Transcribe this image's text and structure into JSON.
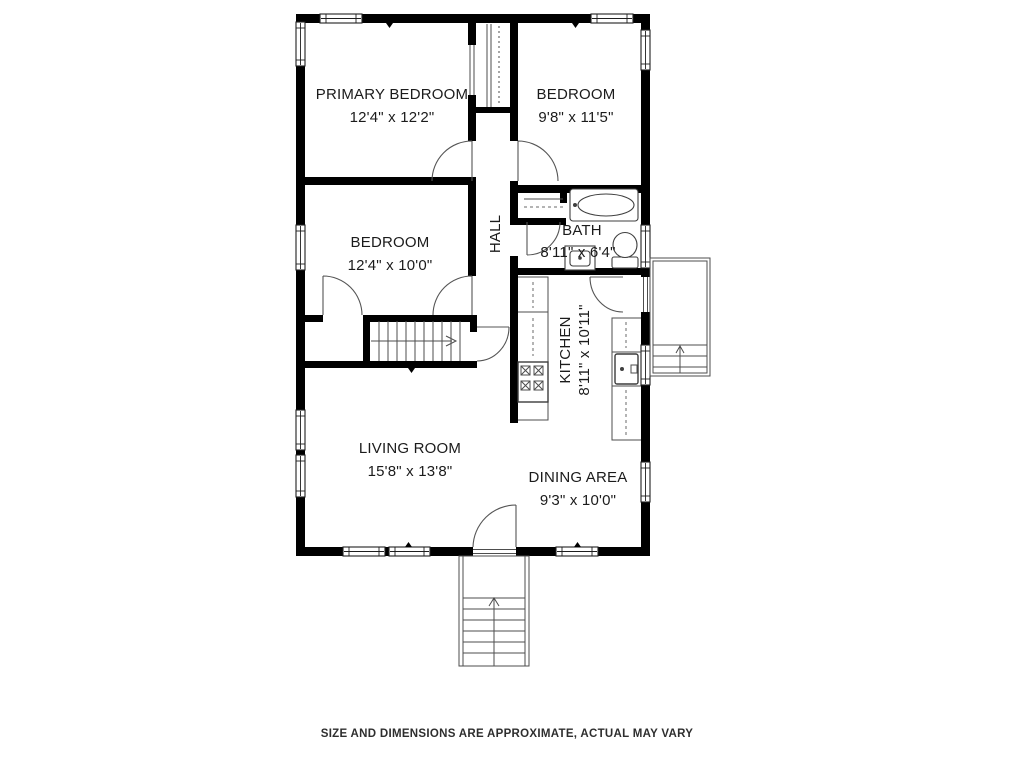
{
  "page": {
    "background_color": "#ffffff",
    "disclaimer": "SIZE AND DIMENSIONS ARE APPROXIMATE, ACTUAL MAY VARY"
  },
  "floorplan": {
    "wall_color": "#000000",
    "detail_line_color": "#4d4d4d",
    "text_color": "#1b1b1b",
    "rooms": [
      {
        "name": "PRIMARY BEDROOM",
        "dims": "12'4\" x 12'2\""
      },
      {
        "name": "BEDROOM",
        "dims": "9'8\" x 11'5\""
      },
      {
        "name": "BEDROOM",
        "dims": "12'4\" x 10'0\""
      },
      {
        "name": "HALL",
        "dims": ""
      },
      {
        "name": "BATH",
        "dims": "8'11\" x 6'4\""
      },
      {
        "name": "KITCHEN",
        "dims": "8'11\" x 10'11\""
      },
      {
        "name": "LIVING ROOM",
        "dims": "15'8\" x 13'8\""
      },
      {
        "name": "DINING AREA",
        "dims": "9'3\" x 10'0\""
      }
    ],
    "feature_icons": [
      "bathtub-icon",
      "toilet-icon",
      "bathroom-sink-icon",
      "stove-icon",
      "kitchen-sink-icon",
      "basement-stairs-icon",
      "front-entry-stairs-icon",
      "side-porch-stairs-icon",
      "attic-shaft-icon"
    ]
  }
}
